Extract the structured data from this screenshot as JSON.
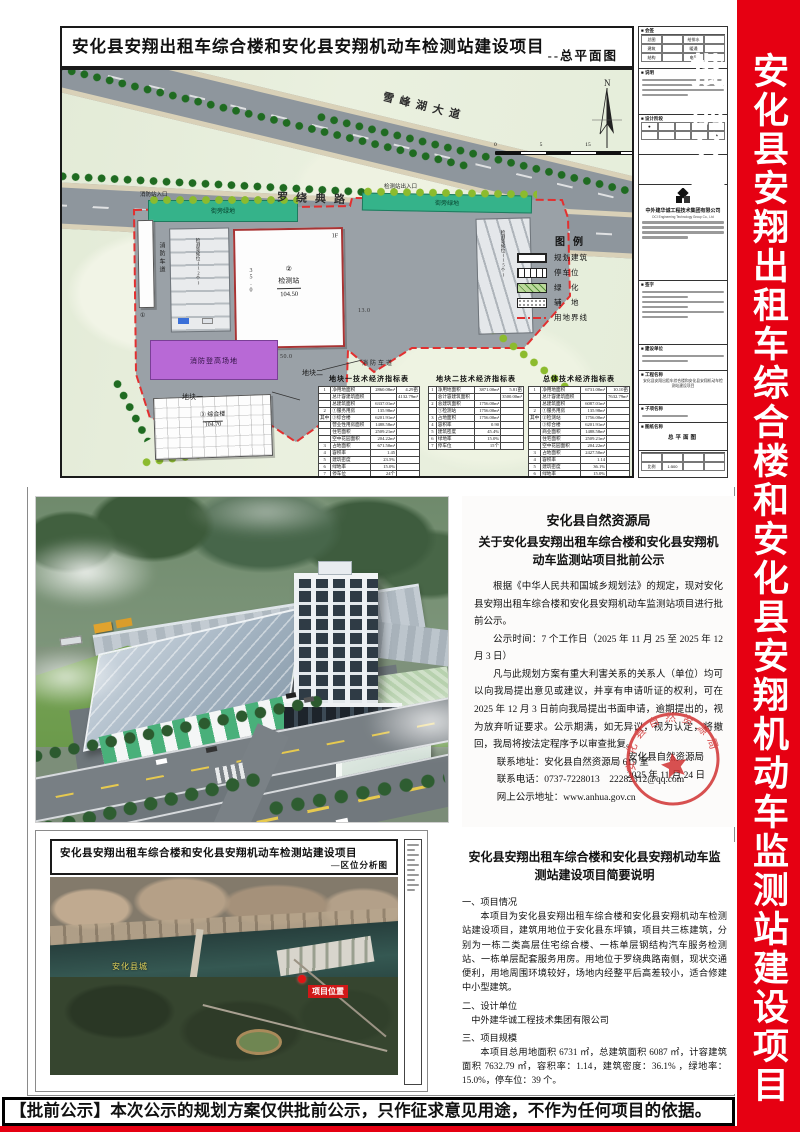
{
  "page": {
    "banner_text": "安化县安翔出租车综合楼和安化县安翔机动车监测站建设项目批前公示",
    "banner_color": "#e60012",
    "bottom_notice": "【批前公示】本次公示的规划方案仅供批前公示，只作征求意见用途，不作为任何项目的依据。"
  },
  "siteplan": {
    "title": "安化县安翔出租车综合楼和安化县安翔机动车检测站建设项目",
    "subtitle": "--总平面图",
    "road_xuefeng": "雪峰湖大道",
    "road_luorao": "罗绕典路",
    "labels": {
      "fire_entrance": "消防站入口",
      "station_entrance": "检测站出入口",
      "station_no": "②",
      "station_name": "检测站",
      "station_elev": "104.50",
      "station_floor": "1F",
      "tower_no": "③",
      "tower_name": "综合楼",
      "tower_elev": "104.70",
      "service_no": "①",
      "fire_site": "消防登高场地",
      "fire_lane": "消防车道",
      "green_strip": "街旁绿地",
      "parking_left": "检测等候位(12个)",
      "parking_right": "检测等候位(15个)",
      "plot1": "地块一",
      "plot2": "地块二",
      "dim_w": "50.0",
      "dim_h": "35.0",
      "dim_r": "13.0",
      "north": "N"
    },
    "scalebar": [
      "0",
      "5",
      "15",
      "30M"
    ],
    "legend": {
      "title": "图例",
      "items": [
        "规划建筑",
        "停车位",
        "绿　化",
        "辅　地",
        "用地界线"
      ]
    },
    "tables": [
      {
        "title": "地块一技术经济指标表",
        "rows": [
          [
            "1",
            "净用地面积",
            "2860.08m²",
            "4.29亩"
          ],
          [
            "",
            "总计容建筑面积",
            "",
            "4132.79m²"
          ],
          [
            "",
            "总建筑面积",
            "6337.01m²",
            ""
          ],
          [
            "2",
            "①服务用房",
            "135.98m²",
            ""
          ],
          [
            "其中",
            "③综合楼",
            "6201.91m²",
            ""
          ],
          [
            "",
            "营业性用房面积",
            "1488.58m²",
            ""
          ],
          [
            "",
            "住宅面积",
            "2509.21m²",
            ""
          ],
          [
            "",
            "空中花园面积",
            "204.22m²",
            ""
          ],
          [
            "3",
            "占地面积",
            "671.50m²",
            ""
          ],
          [
            "4",
            "容积率",
            "1.45",
            ""
          ],
          [
            "5",
            "建筑密度",
            "23.5%",
            ""
          ],
          [
            "6",
            "绿地率",
            "15.0%",
            ""
          ],
          [
            "7",
            "停车位",
            "24个",
            ""
          ]
        ]
      },
      {
        "title": "地块二技术经济指标表",
        "rows": [
          [
            "1",
            "净用地面积",
            "3871.00m²",
            "5.81亩"
          ],
          [
            "",
            "总计容建筑面积",
            "",
            "3500.00m²"
          ],
          [
            "2",
            "总建筑面积",
            "1756.00m²",
            ""
          ],
          [
            "",
            "①检测站",
            "1756.00m²",
            ""
          ],
          [
            "3",
            "占地面积",
            "1756.00m²",
            ""
          ],
          [
            "4",
            "容积率",
            "0.90",
            ""
          ],
          [
            "5",
            "建筑密度",
            "45.4%",
            ""
          ],
          [
            "6",
            "绿地率",
            "15.0%",
            ""
          ],
          [
            "7",
            "停车位",
            "15个",
            ""
          ]
        ]
      },
      {
        "title": "总体技术经济指标表",
        "rows": [
          [
            "1",
            "净用地面积",
            "6731.00m²",
            "10.10亩"
          ],
          [
            "",
            "总计容建筑面积",
            "",
            "7632.79m²"
          ],
          [
            "",
            "总建筑面积",
            "6087.01m²",
            ""
          ],
          [
            "2",
            "①服务用房",
            "135.98m²",
            ""
          ],
          [
            "其中",
            "②检测站",
            "1756.00m²",
            ""
          ],
          [
            "",
            "③综合楼",
            "6201.91m²",
            ""
          ],
          [
            "",
            "商业面积",
            "1488.58m²",
            ""
          ],
          [
            "",
            "住宅面积",
            "2509.21m²",
            ""
          ],
          [
            "",
            "空中花园面积",
            "204.22m²",
            ""
          ],
          [
            "3",
            "占地面积",
            "2427.50m²",
            ""
          ],
          [
            "4",
            "容积率",
            "1.14",
            ""
          ],
          [
            "5",
            "建筑密度",
            "36.1%",
            ""
          ],
          [
            "6",
            "绿地率",
            "15.0%",
            ""
          ],
          [
            "7",
            "停车位",
            "39个",
            ""
          ]
        ]
      }
    ],
    "titleblock": {
      "sec_signoff": "会签",
      "sec_notes": "说明",
      "sec_stage": "设计阶段",
      "sec_sign": "签字",
      "sec_owner": "建设单位",
      "sec_project": "工程名称",
      "sec_subitem": "子项名称",
      "sec_drawing": "图纸名称",
      "disc": [
        "总图",
        "给排水",
        "建筑",
        "暖通",
        "结构",
        "电气"
      ],
      "company": "中外建华诚工程技术集团有限公司",
      "company_en": "DCI Engineering Technology Group Co., Ltd",
      "drawing_name": "总平面图",
      "scale_label": "比例",
      "scale": "1:500",
      "dot": "●"
    }
  },
  "notice": {
    "org": "安化县自然资源局",
    "title": "关于安化县安翔出租车综合楼和安化县安翔机动车监测站项目批前公示",
    "p1": "根据《中华人民共和国城乡规划法》的规定，现对安化县安翔出租车综合楼和安化县安翔机动车监测站项目进行批前公示。",
    "p2": "公示时间：7 个工作日（2025 年 11 月 25 至 2025 年 12 月 3 日）",
    "p3": "凡与此规划方案有重大利害关系的关系人（单位）均可以向我局提出意见或建议，并享有申请听证的权利，可在 2025 年 12 月 3 日前向我局提出书面申请，逾期提出的，视为放弃听证要求。公示期满，如无异议，视为认定，将撤回，我局将按法定程序予以审查批复。",
    "contact_addr": "联系地址：安化县自然资源局 619 室",
    "contact_tel": "联系电话：0737-7228013　22282312@qq.com",
    "contact_web": "网上公示地址：www.anhua.gov.cn",
    "stamp_text": "安化县自然资源局",
    "sign_org": "安化县自然资源局",
    "sign_date": "2025 年 11 月 24 日"
  },
  "location_map": {
    "title": "安化县安翔出租车综合楼和安化县安翔机动车检测站建设项目",
    "subtitle": "—区位分析图",
    "marker_label": "项目位置",
    "city_label": "安化县城"
  },
  "brief": {
    "title": "安化县安翔出租车综合楼和安化县安翔机动车监测站建设项目简要说明",
    "h1": "一、项目情况",
    "p1": "本项目为安化县安翔出租车综合楼和安化县安翔机动车检测站建设项目，建筑用地位于安化县东坪镇，项目共三栋建筑，分别为一栋二类高层住宅综合楼、一栋单层钢结构汽车服务检测站、一栋单层配套服务用房。用地位于罗绕典路南侧，现状交通便利，用地周围环境较好，场地内经整平后高差较小，适合修建中小型建筑。",
    "h2": "二、设计单位",
    "p2": "中外建华诚工程技术集团有限公司",
    "h3": "三、项目规模",
    "p3": "本项目总用地面积 6731 ㎡，总建筑面积 6087 ㎡，计容建筑面积 7632.79 ㎡，容积率：1.14，建筑密度：36.1% ，绿地率：15.0%，停车位：39 个。"
  }
}
